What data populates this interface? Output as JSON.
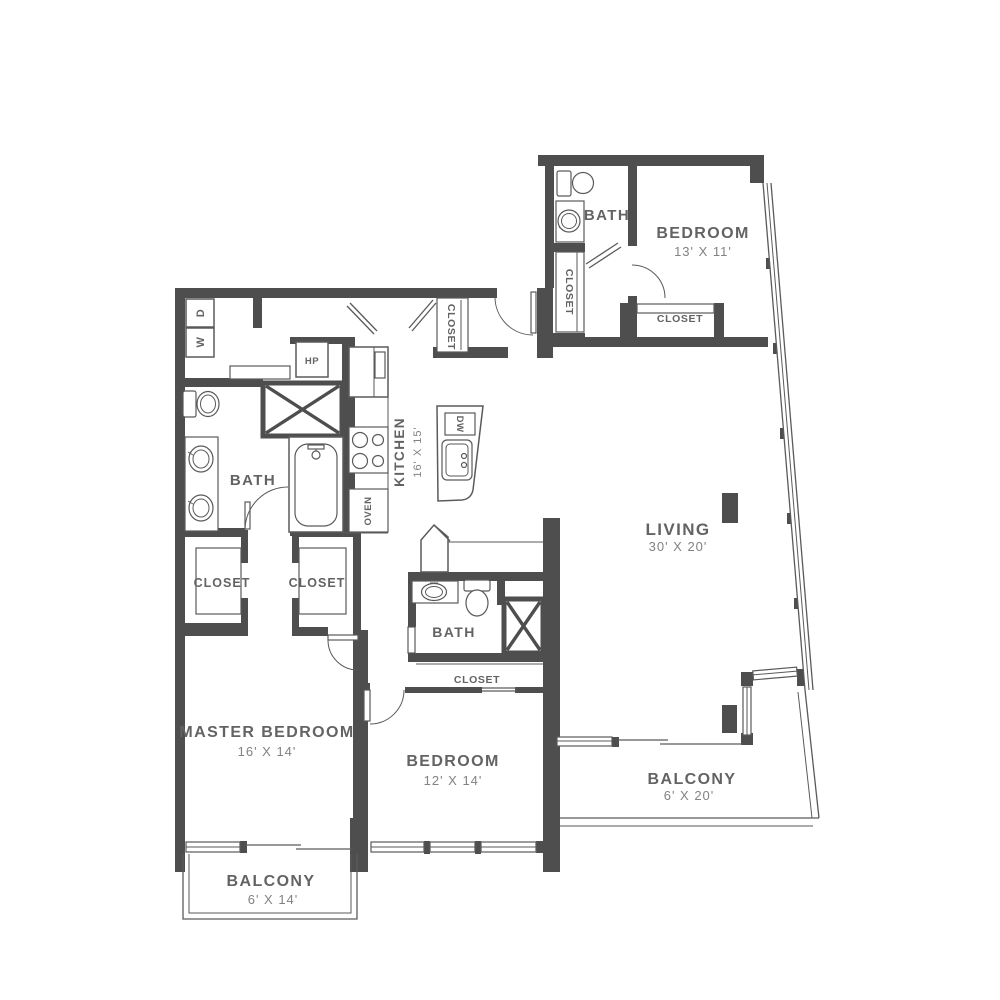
{
  "rooms": {
    "bedroom_upper": {
      "name": "BEDROOM",
      "dims": "13' X 11'"
    },
    "bath_upper": {
      "name": "BATH"
    },
    "closet_upper_hall": {
      "name": "CLOSET"
    },
    "closet_upper_recess": {
      "name": "CLOSET"
    },
    "closet_entry": {
      "name": "CLOSET"
    },
    "kitchen": {
      "name": "KITCHEN",
      "dims": "16' X 15'"
    },
    "living": {
      "name": "LIVING",
      "dims": "30' X 20'"
    },
    "bath_master": {
      "name": "BATH"
    },
    "closet_master_left": {
      "name": "CLOSET"
    },
    "closet_master_right": {
      "name": "CLOSET"
    },
    "master_bedroom": {
      "name": "MASTER BEDROOM",
      "dims": "16' X 14'"
    },
    "bedroom_lower": {
      "name": "BEDROOM",
      "dims": "12' X 14'"
    },
    "bath_lower": {
      "name": "BATH"
    },
    "closet_lower": {
      "name": "CLOSET"
    },
    "balcony_right": {
      "name": "BALCONY",
      "dims": "6' X 20'"
    },
    "balcony_left": {
      "name": "BALCONY",
      "dims": "6' X 14'"
    }
  },
  "appliances": {
    "washer": "W",
    "dryer": "D",
    "heat_pump": "HP",
    "dishwasher": "DW",
    "oven": "OVEN"
  },
  "colors": {
    "wall": "#4e4e4e",
    "label": "#636363",
    "dim_label": "#828282",
    "line": "#5a5a5a"
  }
}
